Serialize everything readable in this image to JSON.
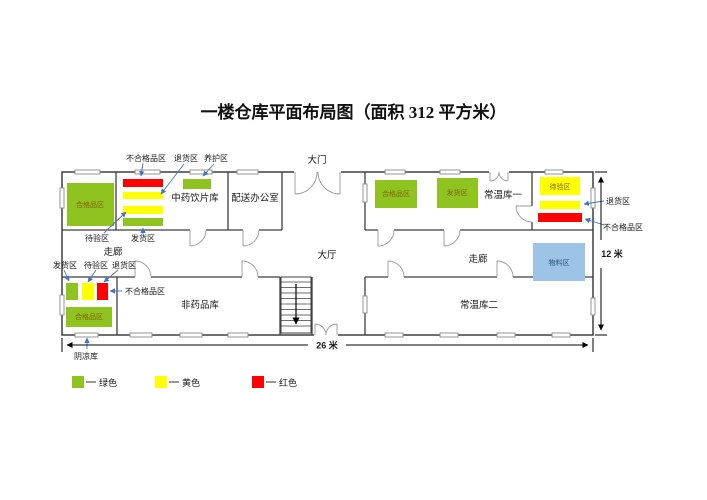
{
  "title": "一楼仓库平面布局图（面积 312 平方米）",
  "rooms": {
    "herb_store": "中药饮片库",
    "delivery_office": "配送办公室",
    "normal_temp_1": "常温库一",
    "normal_temp_2": "常温库二",
    "non_drug": "非药品库",
    "cool_store": "阴凉库"
  },
  "areas": {
    "main_gate": "大门",
    "hall": "大厅",
    "corridor_left": "走廊",
    "corridor_right": "走廊"
  },
  "dimensions": {
    "width_label": "26 米",
    "height_label": "12 米"
  },
  "herb_room": {
    "qualified_box": "合格品区",
    "label_unqualified": "不合格品区",
    "label_return": "退货区",
    "label_care": "养护区",
    "label_await": "待验区",
    "label_ship": "发货区"
  },
  "normal1_room": {
    "box_qualified": "合格品区",
    "box_ship": "发货区"
  },
  "annex_room": {
    "box_await": "待验区",
    "label_return": "退货区",
    "label_unqualified": "不合格品区"
  },
  "material_box": "物料区",
  "cool_room": {
    "label_ship": "发货区",
    "label_await": "待验区",
    "label_return": "退货区",
    "label_unqualified": "不合格品区",
    "qualified_box": "合格品区"
  },
  "legend": {
    "items": [
      {
        "label": "绿色",
        "color": "#8FC31F"
      },
      {
        "label": "黄色",
        "color": "#FFFF00"
      },
      {
        "label": "红色",
        "color": "#FF0000"
      }
    ]
  },
  "colors": {
    "green": "#8FC31F",
    "yellow": "#FFFF00",
    "red": "#FF0000",
    "blue_box": "#9DC3E6",
    "arrow": "#4472C4"
  }
}
